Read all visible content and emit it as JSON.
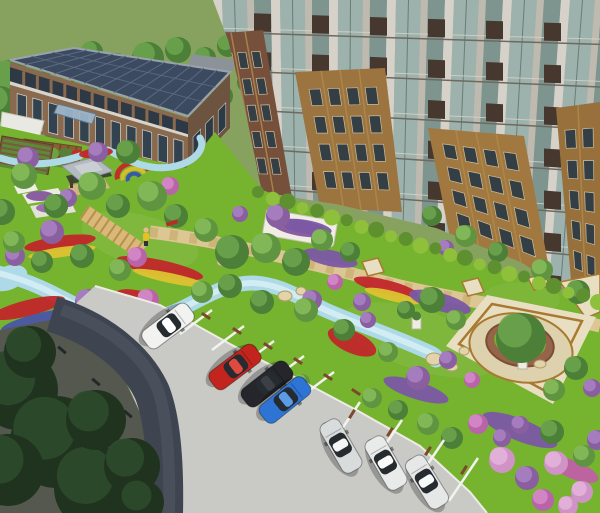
{
  "meta": {
    "description": "Aerial 3D architectural rendering of a residential community landscape: low office building with solar-panel roof, brick high-rise apartment tower, central garden with winding blue stream, flower beds, pavilion, pergola, circular tree plaza, and diagonal parking lot with cars.",
    "view": "top-down aerial, three-point perspective"
  },
  "palette": {
    "field": "#87a25f",
    "lawn": "#76b32f",
    "stream": "#aed9e6",
    "stream_hi": "#d5edf4",
    "boardwalk": "#d9b878",
    "plank": "#b5904f",
    "promenade": "#dcc794",
    "promenade_dash": "#c6a767",
    "gray_path": "#b0b0a8",
    "plaza_paver": "#e8dfc2",
    "plaza_border": "#a87a30",
    "plaza_inner": "#ddd2ad",
    "planter_wall": "#96644a",
    "pavement": "#c9c9c6",
    "curb": "#edebe5",
    "road_dark": "#3e4450",
    "road_mid": "#4c525e",
    "shadow_pave": "#54584f",
    "stall_line": "#f2f2ee",
    "stop_brown": "#7a4a2a",
    "stop_dark": "#23282b",
    "office_roof": "#3c4a60",
    "office_roof_line": "#5b6b84",
    "office_brick": "#8a6a4e",
    "office_brick_dark": "#6d5440",
    "office_glass": "#2d3945",
    "office_trim": "#d7d4cb",
    "canopy": "#9db7cc",
    "annex": "#e9e9e3",
    "back_roof": "#8b9298",
    "tower_base": "#b7b2a7",
    "pier_light": "#d6d2c9",
    "pier": "#bfbab0",
    "glass": "#9db2ac",
    "glass_dark": "#7e948f",
    "mullion": "#6a7d78",
    "floor_line": "#6e6a60",
    "sill": "#d8d4cb",
    "spandrel": "#46382e",
    "brick_pier": "#b08a4c",
    "brick_window": "#333f45",
    "brick_frame": "#cdbd9b",
    "pavilion_roof": "#b3bac0",
    "pavilion_roof_hi": "#c9cfd5",
    "deck": "#d3b285",
    "rock": "#e3d3a8",
    "rock_edge": "#b09c6c",
    "white_planter": "#eceae2",
    "hedge_bright": "#8fc03c",
    "hedge_dark": "#5f9030",
    "tree_n_base": "#4c7f38",
    "tree_n_hi": "#6aa34c",
    "tree_l_base": "#5f9440",
    "tree_l_hi": "#85ba59",
    "tree_d_base": "#20331f",
    "tree_d_hi": "#2e4a2b",
    "bush_p": "#8a5fa0",
    "bush_p_hi": "#a77fc0",
    "bush_m": "#b964a8",
    "bush_m_hi": "#d488c6",
    "bush_k": "#cf93c6",
    "bush_k_hi": "#e3b3da",
    "flower_red": "#c1272a",
    "flower_yellow": "#ddc332",
    "flower_purple": "#7b57a5",
    "flower_magenta": "#bf60a6",
    "flower_blue": "#4a55a8"
  },
  "buildings": {
    "office": {
      "label": "2-story office / clubhouse",
      "roof": "dark solar-panel flat roof",
      "stories": 2
    },
    "tower": {
      "label": "high-rise apartment tower",
      "facade": "glass curtain wall with stone piers, dark spandrels and gold/red brick sections"
    }
  },
  "garden": {
    "features": [
      "pergola",
      "pavilion",
      "community-garden-beds",
      "playground-arcs",
      "winding-stream",
      "boardwalk",
      "promenade",
      "tree-plaza",
      "flower-beds",
      "hedge-row",
      "boulders",
      "white-planters",
      "pedestal-planters"
    ]
  },
  "parking": {
    "surface": "concrete pavement",
    "rows": 2,
    "stall_lines": "white",
    "wheel_stops": "brown"
  },
  "cars": [
    {
      "color_name": "white",
      "body": "#f2f3f1",
      "roof": "#ffffff",
      "x": 168,
      "y": 326,
      "angle": 143
    },
    {
      "color_name": "red",
      "body": "#c2251d",
      "roof": "#de4a40",
      "x": 235,
      "y": 367,
      "angle": 143
    },
    {
      "color_name": "black",
      "body": "#25262b",
      "roof": "#3c3f46",
      "x": 267,
      "y": 384,
      "angle": 142
    },
    {
      "color_name": "blue",
      "body": "#2d74d4",
      "roof": "#5b9be8",
      "x": 285,
      "y": 400,
      "angle": 141
    },
    {
      "color_name": "silver",
      "body": "#d9dcdd",
      "roof": "#f4f6f6",
      "x": 341,
      "y": 446,
      "angle": 60
    },
    {
      "color_name": "white",
      "body": "#e9ebeb",
      "roof": "#fbfbfb",
      "x": 386,
      "y": 463,
      "angle": 60
    },
    {
      "color_name": "white",
      "body": "#e6e8e8",
      "roof": "#f8f9f9",
      "x": 427,
      "y": 482,
      "angle": 58
    }
  ],
  "trees": {
    "back": [
      [
        10,
        82,
        22,
        "n"
      ],
      [
        32,
        104,
        19,
        "n"
      ],
      [
        12,
        126,
        15,
        "n"
      ],
      [
        56,
        94,
        17,
        "n"
      ],
      [
        86,
        80,
        15,
        "n"
      ],
      [
        116,
        68,
        15,
        "n"
      ],
      [
        148,
        58,
        16,
        "n"
      ],
      [
        178,
        50,
        13,
        "n"
      ],
      [
        205,
        58,
        11,
        "n"
      ],
      [
        228,
        46,
        11,
        "n"
      ],
      [
        38,
        70,
        13,
        "n"
      ],
      [
        92,
        52,
        11,
        "n"
      ],
      [
        0,
        104,
        18,
        "n"
      ],
      [
        64,
        118,
        13,
        "n"
      ],
      [
        58,
        128,
        15,
        "n"
      ],
      [
        92,
        142,
        13,
        "n"
      ],
      [
        128,
        152,
        12,
        "n"
      ],
      [
        162,
        148,
        12,
        "n"
      ],
      [
        196,
        122,
        10,
        "n"
      ],
      [
        222,
        96,
        11,
        "n"
      ],
      [
        248,
        82,
        11,
        "n"
      ],
      [
        210,
        78,
        9,
        "n"
      ],
      [
        24,
        176,
        13,
        "L"
      ],
      [
        56,
        206,
        12,
        "n"
      ],
      [
        92,
        186,
        14,
        "L"
      ],
      [
        118,
        206,
        12,
        "n"
      ],
      [
        152,
        196,
        15,
        "L"
      ],
      [
        176,
        216,
        12,
        "n"
      ],
      [
        206,
        230,
        12,
        "L"
      ],
      [
        232,
        252,
        17,
        "n"
      ],
      [
        266,
        248,
        15,
        "L"
      ],
      [
        296,
        262,
        14,
        "n"
      ],
      [
        322,
        240,
        11,
        "L"
      ],
      [
        350,
        252,
        10,
        "n"
      ],
      [
        230,
        286,
        12,
        "n"
      ],
      [
        202,
        292,
        11,
        "L"
      ],
      [
        262,
        302,
        12,
        "n"
      ],
      [
        306,
        310,
        12,
        "L"
      ],
      [
        344,
        330,
        11,
        "n"
      ],
      [
        388,
        352,
        10,
        "L"
      ],
      [
        82,
        256,
        12,
        "n"
      ],
      [
        120,
        270,
        11,
        "L"
      ],
      [
        42,
        262,
        11,
        "n"
      ],
      [
        2,
        212,
        13,
        "n"
      ],
      [
        14,
        242,
        11,
        "L"
      ],
      [
        432,
        216,
        10,
        "n"
      ],
      [
        466,
        236,
        11,
        "L"
      ],
      [
        498,
        252,
        10,
        "n"
      ],
      [
        542,
        270,
        11,
        "L"
      ],
      [
        578,
        292,
        12,
        "n"
      ],
      [
        521,
        338,
        25,
        "n"
      ],
      [
        576,
        368,
        12,
        "n"
      ],
      [
        554,
        390,
        11,
        "L"
      ],
      [
        432,
        300,
        13,
        "n"
      ],
      [
        456,
        320,
        10,
        "L"
      ],
      [
        406,
        310,
        9,
        "n"
      ],
      [
        372,
        398,
        10,
        "L"
      ],
      [
        398,
        410,
        10,
        "n"
      ],
      [
        428,
        424,
        11,
        "L"
      ],
      [
        452,
        438,
        11,
        "n"
      ],
      [
        302,
        382,
        8,
        "L"
      ]
    ],
    "front": [
      [
        18,
        390,
        40,
        "D"
      ],
      [
        56,
        442,
        46,
        "D"
      ],
      [
        96,
        488,
        42,
        "D"
      ],
      [
        30,
        352,
        26,
        "D"
      ],
      [
        96,
        420,
        30,
        "D"
      ],
      [
        132,
        466,
        28,
        "D"
      ],
      [
        8,
        470,
        36,
        "D"
      ],
      [
        142,
        502,
        22,
        "D"
      ],
      [
        552,
        432,
        12,
        "n"
      ],
      [
        584,
        456,
        11,
        "L"
      ]
    ]
  },
  "bushes": {
    "back": [
      [
        98,
        152,
        10,
        "p"
      ],
      [
        28,
        158,
        11,
        "p"
      ],
      [
        52,
        232,
        12,
        "p"
      ],
      [
        88,
        302,
        13,
        "p"
      ],
      [
        148,
        300,
        11,
        "m"
      ],
      [
        137,
        257,
        10,
        "m"
      ],
      [
        278,
        216,
        12,
        "p"
      ],
      [
        312,
        300,
        10,
        "p"
      ],
      [
        362,
        302,
        9,
        "p"
      ],
      [
        418,
        378,
        12,
        "p"
      ],
      [
        446,
        248,
        8,
        "p"
      ],
      [
        592,
        388,
        9,
        "p"
      ],
      [
        68,
        198,
        9,
        "p"
      ],
      [
        15,
        256,
        10,
        "p"
      ],
      [
        478,
        424,
        10,
        "m"
      ],
      [
        502,
        438,
        9,
        "p"
      ],
      [
        170,
        186,
        9,
        "m"
      ],
      [
        240,
        214,
        8,
        "p"
      ],
      [
        335,
        282,
        8,
        "m"
      ],
      [
        368,
        320,
        8,
        "p"
      ],
      [
        448,
        360,
        9,
        "p"
      ],
      [
        472,
        380,
        8,
        "m"
      ]
    ],
    "front": [
      [
        502,
        460,
        13,
        "k"
      ],
      [
        527,
        478,
        12,
        "p"
      ],
      [
        556,
        463,
        12,
        "k"
      ],
      [
        582,
        492,
        11,
        "k"
      ],
      [
        597,
        440,
        10,
        "p"
      ],
      [
        543,
        500,
        11,
        "m"
      ],
      [
        568,
        506,
        10,
        "k"
      ],
      [
        520,
        425,
        9,
        "p"
      ]
    ]
  },
  "flowerbeds": [
    [
      60,
      243,
      36,
      7,
      -8,
      "flower_red"
    ],
    [
      62,
      252,
      34,
      5,
      -8,
      "flower_yellow"
    ],
    [
      28,
      308,
      38,
      8,
      -14,
      "flower_red"
    ],
    [
      40,
      320,
      40,
      7,
      -14,
      "flower_blue"
    ],
    [
      54,
      331,
      38,
      6,
      -12,
      "flower_yellow"
    ],
    [
      160,
      268,
      44,
      8,
      12,
      "flower_red"
    ],
    [
      170,
      278,
      38,
      5,
      12,
      "flower_yellow"
    ],
    [
      386,
      287,
      33,
      7,
      14,
      "flower_red"
    ],
    [
      392,
      296,
      28,
      5,
      14,
      "flower_yellow"
    ],
    [
      352,
      342,
      26,
      11,
      24,
      "flower_red"
    ],
    [
      96,
      153,
      17,
      5,
      -6,
      "flower_red"
    ],
    [
      136,
      296,
      20,
      6,
      10,
      "flower_red"
    ],
    [
      306,
      227,
      26,
      7,
      10,
      "flower_purple"
    ],
    [
      330,
      258,
      28,
      8,
      12,
      "flower_purple"
    ],
    [
      440,
      302,
      32,
      9,
      16,
      "flower_purple"
    ],
    [
      520,
      430,
      40,
      11,
      22,
      "flower_purple"
    ],
    [
      574,
      470,
      26,
      9,
      22,
      "flower_magenta"
    ],
    [
      416,
      390,
      34,
      9,
      18,
      "flower_purple"
    ]
  ],
  "rocks": [
    [
      152,
      332,
      9,
      6
    ],
    [
      172,
      341,
      8,
      5
    ],
    [
      191,
      347,
      6,
      4
    ],
    [
      285,
      296,
      7,
      5
    ],
    [
      301,
      291,
      5,
      4
    ],
    [
      434,
      359,
      8,
      6
    ],
    [
      452,
      367,
      6,
      4
    ],
    [
      464,
      351,
      5,
      4
    ],
    [
      222,
      262,
      5,
      4
    ],
    [
      540,
      364,
      6,
      4
    ]
  ],
  "stall_lines": [
    [
      212,
      310,
      180,
      334
    ],
    [
      244,
      326,
      212,
      350
    ],
    [
      274,
      341,
      242,
      365
    ],
    [
      304,
      356,
      272,
      380
    ],
    [
      334,
      372,
      302,
      396
    ],
    [
      360,
      402,
      331,
      445
    ],
    [
      402,
      420,
      373,
      463
    ],
    [
      444,
      440,
      415,
      483
    ],
    [
      478,
      458,
      449,
      501
    ]
  ],
  "wheel_stops": [
    [
      206,
      316,
      33,
      "b"
    ],
    [
      237,
      331,
      33,
      "b"
    ],
    [
      268,
      346,
      33,
      "b"
    ],
    [
      298,
      361,
      33,
      "b"
    ],
    [
      328,
      377,
      33,
      "b"
    ],
    [
      356,
      392,
      33,
      "b"
    ],
    [
      352,
      414,
      -58,
      "b"
    ],
    [
      390,
      432,
      -58,
      "b"
    ],
    [
      428,
      451,
      -58,
      "b"
    ],
    [
      464,
      470,
      -58,
      "b"
    ],
    [
      62,
      350,
      40,
      "d"
    ],
    [
      96,
      382,
      40,
      "d"
    ],
    [
      128,
      414,
      40,
      "d"
    ]
  ],
  "tower_cfg": {
    "mass": "213,0 600,0 600,310 520,262 436,228 340,205 262,192 243,100 228,40",
    "pattern": [
      [
        "pier_light",
        9
      ],
      [
        "glass",
        25
      ],
      [
        "pier",
        7
      ],
      [
        "glass_dark",
        17
      ]
    ],
    "floors": 8,
    "floor_h": 38,
    "fan_cx": 330,
    "fan_k": 0.1,
    "brick_patches": [
      {
        "pts": [
          [
            213,
            34
          ],
          [
            263,
            30
          ],
          [
            292,
            198
          ],
          [
            243,
            196
          ]
        ],
        "fill": "#77503c",
        "rows": 5,
        "cols": 3
      },
      {
        "pts": [
          [
            295,
            72
          ],
          [
            385,
            68
          ],
          [
            402,
            212
          ],
          [
            320,
            208
          ]
        ],
        "fill": "#9c7440",
        "rows": 4,
        "cols": 4
      },
      {
        "pts": [
          [
            428,
            128
          ],
          [
            524,
            136
          ],
          [
            552,
            284
          ],
          [
            450,
            238
          ]
        ],
        "fill": "#a1783f",
        "rows": 4,
        "cols": 4
      },
      {
        "pts": [
          [
            556,
            108
          ],
          [
            600,
            102
          ],
          [
            600,
            308
          ],
          [
            572,
            292
          ]
        ],
        "fill": "#97703c",
        "rows": 5,
        "cols": 2
      }
    ]
  },
  "hedge_row": {
    "x1": 258,
    "y1": 192,
    "x2": 598,
    "y2": 300,
    "count": 24
  }
}
